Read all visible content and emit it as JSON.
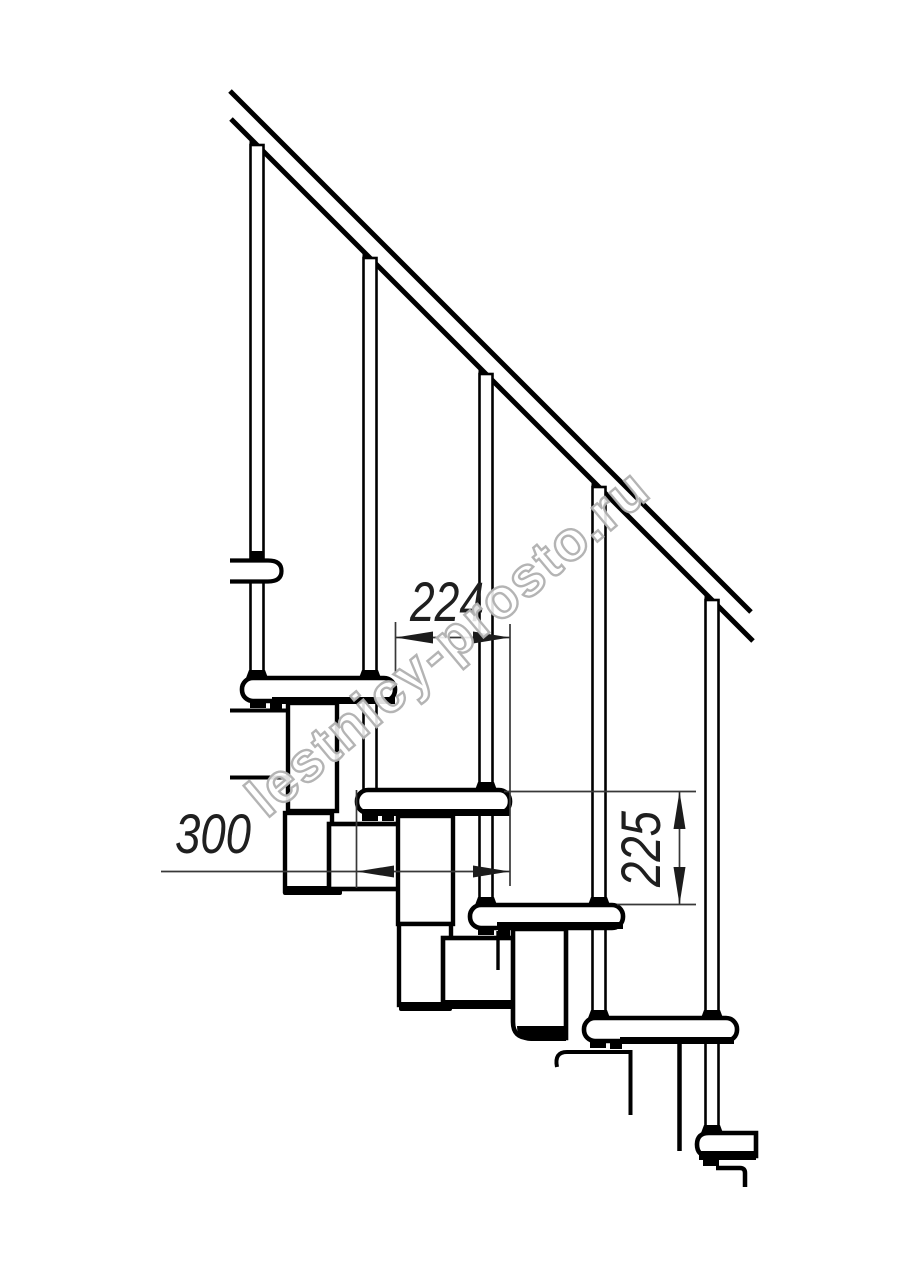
{
  "page": {
    "width": 914,
    "height": 1280,
    "background": "#ffffff"
  },
  "drawing": {
    "subject": "modular staircase side elevation",
    "line_color": "#000000",
    "dimension_color": "#383838",
    "parts": {
      "handrail": "handrail",
      "balusters": 5,
      "treads": 5,
      "stringer_modules": 7
    }
  },
  "dimensions": {
    "going": {
      "value": "224",
      "orientation": "horizontal"
    },
    "tread_depth": {
      "value": "300",
      "orientation": "horizontal"
    },
    "riser_height": {
      "value": "225",
      "orientation": "vertical"
    }
  },
  "watermark": {
    "text": "lestnicy-prosto.ru",
    "outline_color": "#b0b0b0"
  }
}
